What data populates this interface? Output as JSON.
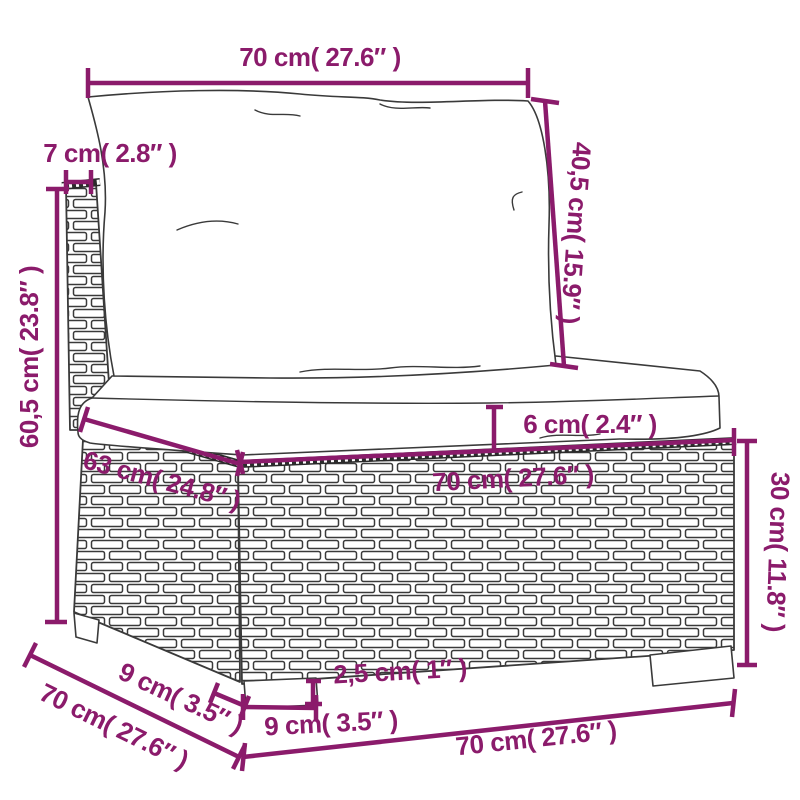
{
  "diagram_type": "product-dimension-diagram",
  "subject": "rattan-sofa-middle-section",
  "colors": {
    "dimension": "#8b1b6b",
    "drawing_line": "#3a3a3a",
    "background": "#ffffff"
  },
  "labels": {
    "back_top_width": "70 cm( 27.6″ )",
    "back_frame_thickness": "7 cm( 2.8″ )",
    "back_height": "60,5 cm( 23.8″ )",
    "back_cushion_height": "40,5 cm( 15.9″ )",
    "seat_depth": "63 cm( 24.8″ )",
    "seat_cushion_thickness": "6 cm( 2.4″ )",
    "seat_width": "70 cm( 27.6″ )",
    "base_height": "30 cm( 11.8″ )",
    "foot_height": "2,5 cm( 1″ )",
    "front_foot_width": "9 cm( 3.5″ )",
    "side_foot_depth": "9 cm( 3.5″ )",
    "overall_depth": "70 cm( 27.6″ )",
    "overall_width": "70 cm( 27.6″ )"
  }
}
